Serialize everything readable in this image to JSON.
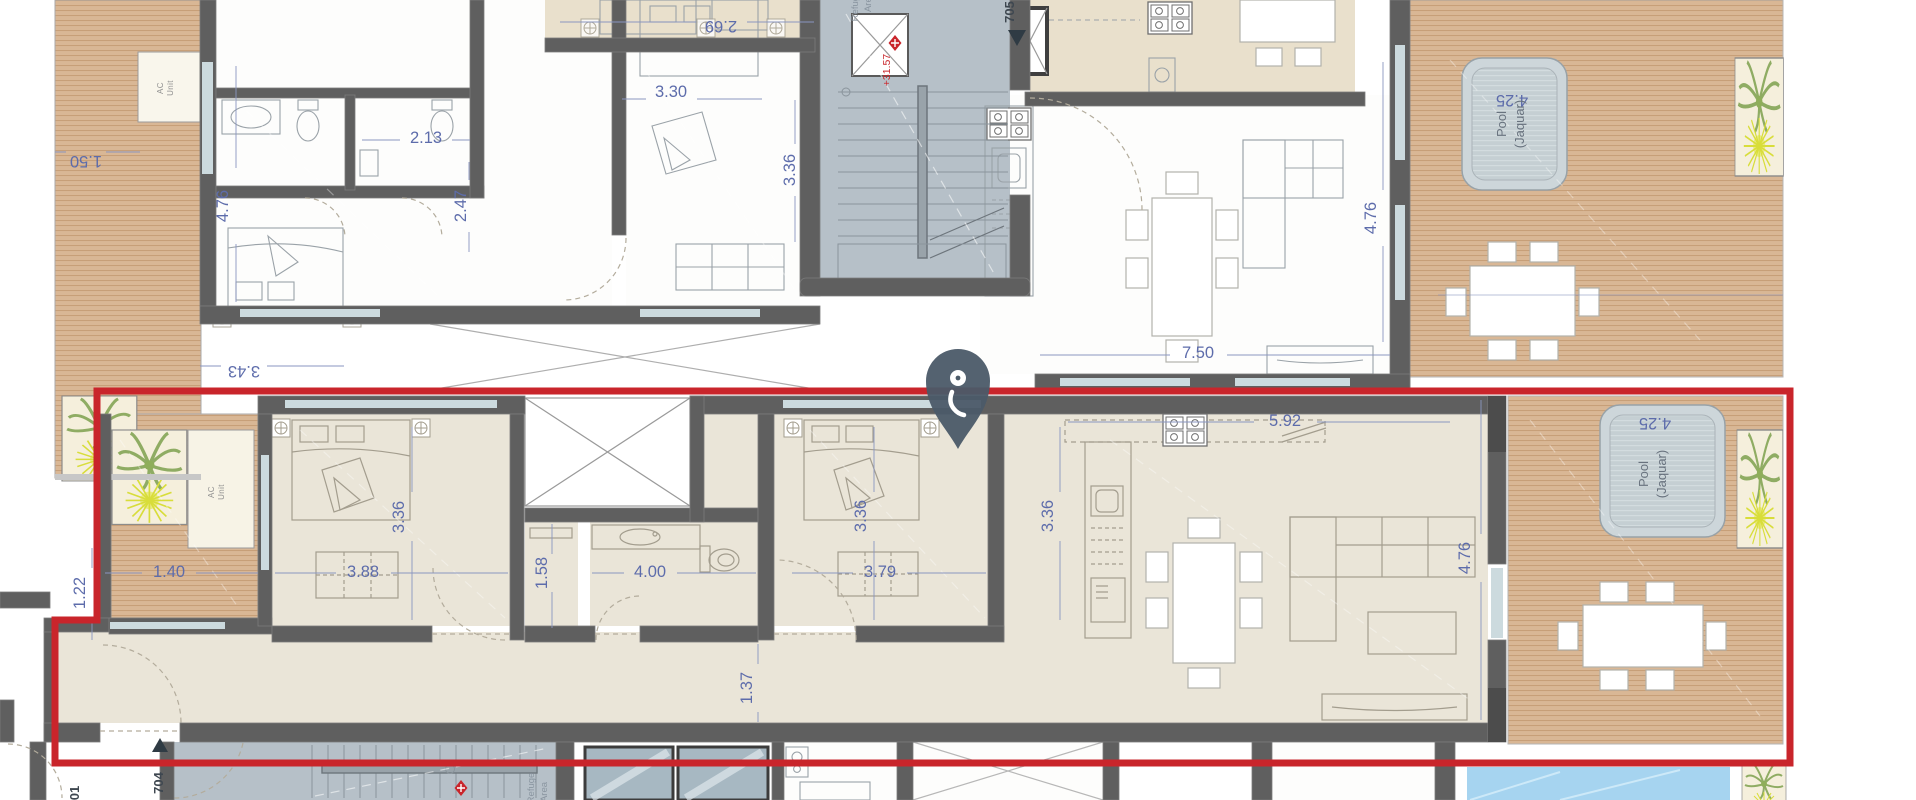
{
  "plan": {
    "type": "apartment-floor-plan",
    "highlight_color": "#c9252b",
    "pin_color": "#4b5a68",
    "dim_text_color": "#5d6cab",
    "labels": [
      {
        "text": "2.69",
        "x": 721,
        "y": 21,
        "rot": 180,
        "cls": "dim"
      },
      {
        "text": "3.30",
        "x": 671,
        "y": 97,
        "rot": 0,
        "cls": "dim"
      },
      {
        "text": "3.36",
        "x": 795,
        "y": 170,
        "rot": -90,
        "cls": "dim"
      },
      {
        "text": "2.13",
        "x": 426,
        "y": 143,
        "rot": 0,
        "cls": "dim"
      },
      {
        "text": "2.47",
        "x": 466,
        "y": 206,
        "rot": -90,
        "cls": "dim"
      },
      {
        "text": "4.76",
        "x": 228,
        "y": 206,
        "rot": -90,
        "cls": "dim"
      },
      {
        "text": "1.50",
        "x": 86,
        "y": 156,
        "rot": 180,
        "cls": "dim"
      },
      {
        "text": "3.43",
        "x": 244,
        "y": 366,
        "rot": 180,
        "cls": "dim"
      },
      {
        "text": "7.50",
        "x": 1198,
        "y": 358,
        "rot": 0,
        "cls": "dim"
      },
      {
        "text": "4.76",
        "x": 1376,
        "y": 218,
        "rot": -90,
        "cls": "dim"
      },
      {
        "text": "AC",
        "x": 163,
        "y": 88,
        "rot": -90,
        "cls": "tiny"
      },
      {
        "text": "Unit",
        "x": 173,
        "y": 88,
        "rot": -90,
        "cls": "tiny"
      },
      {
        "text": "+31.57",
        "x": 890,
        "y": 70,
        "rot": -90,
        "cls": "red-lbl"
      },
      {
        "text": "705",
        "x": 1014,
        "y": 12,
        "rot": -90,
        "cls": "unit-lbl"
      },
      {
        "text": "Refuge",
        "x": 858,
        "y": 6,
        "rot": -90,
        "cls": "core-lbl"
      },
      {
        "text": "Area",
        "x": 871,
        "y": 2,
        "rot": -90,
        "cls": "core-lbl"
      },
      {
        "text": "4.25",
        "x": 1512,
        "y": 95,
        "rot": 180,
        "cls": "dim"
      },
      {
        "text": "Pool",
        "x": 1506,
        "y": 124,
        "rot": -90,
        "cls": "pool-lbl"
      },
      {
        "text": "(Jaquar)",
        "x": 1524,
        "y": 124,
        "rot": -90,
        "cls": "pool-lbl"
      },
      {
        "text": "1.40",
        "x": 169,
        "y": 577,
        "rot": 0,
        "cls": "dim"
      },
      {
        "text": "3.88",
        "x": 363,
        "y": 577,
        "rot": 0,
        "cls": "dim"
      },
      {
        "text": "1.58",
        "x": 547,
        "y": 573,
        "rot": -90,
        "cls": "dim"
      },
      {
        "text": "4.00",
        "x": 650,
        "y": 577,
        "rot": 0,
        "cls": "dim"
      },
      {
        "text": "3.79",
        "x": 880,
        "y": 577,
        "rot": 0,
        "cls": "dim"
      },
      {
        "text": "3.36",
        "x": 404,
        "y": 517,
        "rot": -90,
        "cls": "dim"
      },
      {
        "text": "3.36",
        "x": 866,
        "y": 516,
        "rot": -90,
        "cls": "dim"
      },
      {
        "text": "3.36",
        "x": 1053,
        "y": 516,
        "rot": -90,
        "cls": "dim"
      },
      {
        "text": "5.92",
        "x": 1285,
        "y": 426,
        "rot": 0,
        "cls": "dim"
      },
      {
        "text": "4.76",
        "x": 1470,
        "y": 558,
        "rot": -90,
        "cls": "dim"
      },
      {
        "text": "1.37",
        "x": 752,
        "y": 688,
        "rot": -90,
        "cls": "dim"
      },
      {
        "text": "1.22",
        "x": 85,
        "y": 593,
        "rot": -90,
        "cls": "dim"
      },
      {
        "text": "AC",
        "x": 214,
        "y": 492,
        "rot": -90,
        "cls": "tiny"
      },
      {
        "text": "Unit",
        "x": 224,
        "y": 492,
        "rot": -90,
        "cls": "tiny"
      },
      {
        "text": "4.25",
        "x": 1655,
        "y": 418,
        "rot": 180,
        "cls": "dim"
      },
      {
        "text": "Pool",
        "x": 1648,
        "y": 474,
        "rot": -90,
        "cls": "pool-lbl"
      },
      {
        "text": "(Jaquar)",
        "x": 1666,
        "y": 474,
        "rot": -90,
        "cls": "pool-lbl"
      },
      {
        "text": "704",
        "x": 163,
        "y": 783,
        "rot": -90,
        "cls": "unit-lbl"
      },
      {
        "text": "01",
        "x": 79,
        "y": 793,
        "rot": -90,
        "cls": "unit-lbl"
      },
      {
        "text": "Refuge",
        "x": 534,
        "y": 788,
        "rot": -90,
        "cls": "core-lbl"
      },
      {
        "text": "Area",
        "x": 547,
        "y": 792,
        "rot": -90,
        "cls": "core-lbl"
      }
    ],
    "level_markers": [
      {
        "name": "level-diamond-top",
        "x": 895,
        "y": 43
      },
      {
        "name": "level-diamond-bottom",
        "x": 461,
        "y": 788
      }
    ],
    "direction_triangles": [
      {
        "name": "entry-arrow-top",
        "points": "1008,30 1026,30 1017,46"
      },
      {
        "name": "entry-arrow-bottom",
        "points": "152,752 168,752 160,738"
      }
    ]
  }
}
